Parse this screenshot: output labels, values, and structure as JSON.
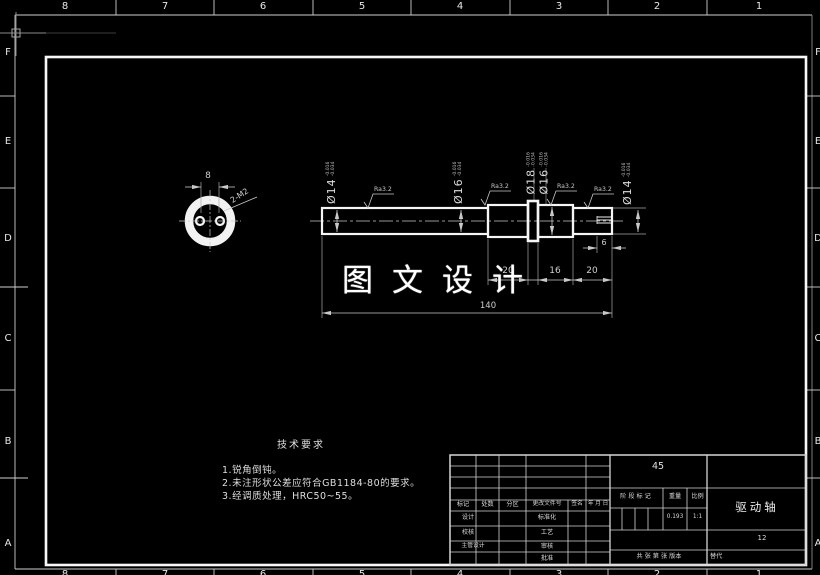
{
  "zones": {
    "top": [
      "8",
      "7",
      "6",
      "5",
      "4",
      "3",
      "2",
      "1"
    ],
    "bottom": [
      "8",
      "7",
      "6",
      "5",
      "4",
      "3",
      "2",
      "1"
    ],
    "left": [
      "F",
      "E",
      "D",
      "C",
      "B",
      "A"
    ],
    "right": [
      "F",
      "E",
      "D",
      "C",
      "B",
      "A"
    ]
  },
  "watermark": "图文设计",
  "end_view": {
    "hole_spacing": "8",
    "thread_note": "2-M2"
  },
  "surface_finish": "Ra3.2",
  "dia_labels": [
    {
      "text": "Ø14",
      "tol_u": "-0.016",
      "tol_l": "-0.034"
    },
    {
      "text": "Ø16",
      "tol_u": "-0.016",
      "tol_l": "-0.034"
    },
    {
      "text": "Ø18",
      "tol_u": "-0.016",
      "tol_l": "-0.034"
    },
    {
      "text": "Ø16",
      "tol_u": "-0.016",
      "tol_l": "-0.034"
    },
    {
      "text": "Ø14",
      "tol_u": "-0.016",
      "tol_l": "-0.034"
    }
  ],
  "dims": {
    "seg_a": "20",
    "seg_b": "16",
    "seg_c": "20",
    "thread_len": "6",
    "total": "140"
  },
  "tech_req": {
    "heading": "技术要求",
    "items": [
      "1.锐角倒钝。",
      "2.未注形状公差应符合GB1184-80的要求。",
      "3.经调质处理，HRC50~55。"
    ]
  },
  "title_block": {
    "rev_header": [
      "标记",
      "处数",
      "分区",
      "更改文件号",
      "签名",
      "年 月 日"
    ],
    "roles": [
      {
        "left": "设计",
        "right": "标准化"
      },
      {
        "left": "校核",
        "right": "工艺"
      },
      {
        "left": "主管设计",
        "right": "审核"
      },
      {
        "left": "",
        "right": "批准"
      }
    ],
    "material": "45",
    "stage_label": "阶段标记",
    "weight_label": "重量",
    "weight_value": "0.193",
    "scale_label": "比例",
    "scale_value": "1:1",
    "sheet_info": "共 张 第 张 版本",
    "part_name": "驱动轴",
    "drawing_no": "12",
    "replace_label": "替代"
  }
}
